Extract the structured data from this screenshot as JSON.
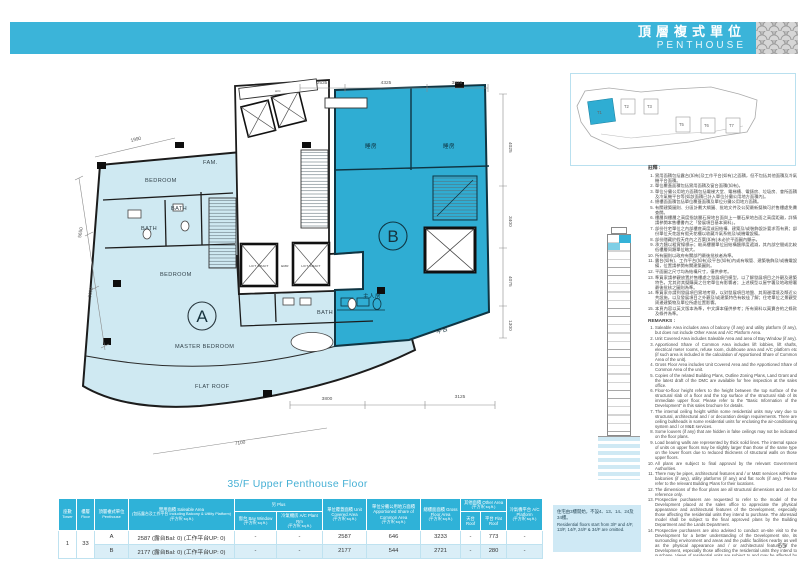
{
  "page": {
    "number": "55",
    "caption": "35/F Upper Penthouse Floor",
    "accent_color": "#3bb4d9",
    "unit_b_color": "#2fadd3",
    "unit_a_color": "#cfe9f2"
  },
  "header": {
    "title_zh": "頂層複式單位",
    "title_en": "PENTHOUSE"
  },
  "keyplan": {
    "towers": [
      "T1",
      "T2",
      "T3",
      "T5",
      "T6",
      "T7"
    ]
  },
  "plan": {
    "unit_a_label": "A",
    "unit_b_label": "B",
    "rooms": {
      "bedroom1": "BEDROOM",
      "fam": "FAM.",
      "bath1": "BATH",
      "bath2": "BATH",
      "bedroom2": "BEDROOM",
      "master_bedroom": "MASTER BEDROOM",
      "flat_roof": "FLAT ROOF",
      "bath3": "BATH",
      "lift_shaft1": "LIFT SHAFT",
      "emr": "EMR",
      "lift_shaft2": "LIFT SHAFT",
      "ac": "A/C",
      "bedroom_zh1": "睡房",
      "bedroom_zh2": "睡房",
      "master_zh": "主人房",
      "flat_roof_zh": "平台"
    },
    "dims": {
      "top": [
        "2535",
        "4325",
        "3825"
      ],
      "right": [
        "4025",
        "3400",
        "4075",
        "1300"
      ],
      "bottom": [
        "3800",
        "3125"
      ],
      "left": [
        "1990",
        "5650",
        "3600"
      ],
      "diagonal": "7100"
    }
  },
  "table": {
    "headers": {
      "tower": {
        "l1": "座數",
        "l2": "Tower"
      },
      "floor": {
        "l1": "樓層",
        "l2": "Floor"
      },
      "penthouse": {
        "l1": "頂層複式單位",
        "l2": "Penthouse"
      },
      "saleable": {
        "l1": "實用面積 Saleable Area",
        "l2": "(包括露台及工作平台 Including Balcony & Utility Platform)",
        "l3": "(平方呎 sq.ft.)"
      },
      "plus": {
        "l1": "另 Plus"
      },
      "bay_window": {
        "l1": "窗台 Bay Window",
        "l2": "(平方呎 sq.ft.)"
      },
      "ac_plant": {
        "l1": "冷氣機房 A/C Plant Rm",
        "l2": "(平方呎 sq.ft.)"
      },
      "unit_covered": {
        "l1": "單位覆蓋面積 Unit Covered Area",
        "l2": "(平方呎 sq.ft.)"
      },
      "apportioned": {
        "l1": "單位分攤公用地方面積 Apportioned Share of Common Area",
        "l2": "(平方呎 sq.ft.)"
      },
      "gfa": {
        "l1": "總樓面面積 Gross Floor Area",
        "l2": "(平方呎 sq.ft.)"
      },
      "other": {
        "l1": "其他面積 Other Area",
        "l2": "(平方呎 sq.ft.)"
      },
      "roof": {
        "l1": "天台 Roof"
      },
      "flat_roof": {
        "l1": "平台 Flat Roof"
      },
      "ac_platform": {
        "l1": "冷氣機平台 A/C Platform",
        "l2": "(平方呎 sq.ft.)"
      }
    },
    "rows": [
      {
        "tower": "1",
        "floor": "33",
        "unit": "A",
        "saleable": "2587 (露台Bal: 0) (工作平台UP: 0)",
        "bay": "-",
        "ac_plant": "-",
        "covered": "2587",
        "apportioned": "646",
        "gfa": "3233",
        "roof": "-",
        "flat_roof": "773",
        "ac_platform": "-"
      },
      {
        "unit": "B",
        "saleable": "2177 (露台Bal: 0) (工作平台UP: 0)",
        "bay": "-",
        "ac_plant": "-",
        "covered": "2177",
        "apportioned": "544",
        "gfa": "2721",
        "roof": "-",
        "flat_roof": "280",
        "ac_platform": "-"
      }
    ],
    "note_zh": "住宅由3樓開始，不設4、13、14、24及34樓。",
    "note_en": "Residential floors start from 3/F and 4/F, 13/F, 14/F, 24/F & 34/F are omitted."
  },
  "remarks": {
    "title_zh": "註釋 :",
    "title_en": "REMARKS :",
    "zh": [
      "實用面積包括露台(如有)及工作平台(如有)之面積，但不包括其他面積及冷氣機平台面積。",
      "單位覆蓋面積包括實用面積及窗台面積(如有)。",
      "單位分攤公用地方面積包括電梯大堂、電梯槽、電錶房、垃圾房、會所面積及冷氣機平台等(如該面積已計入單位分攤公用地方面積內)。",
      "總樓面面積包括單位覆蓋面積及單位分攤公用地方面積。",
      "有關建築圖則、分區計劃大綱圖、批地文件及公契最新擬稿可於售樓處免費查閱。",
      "樓層與樓層之高度指該層石屎地台面與上一層石屎地台面之高度距離，詳情請參閱本售樓書內之「發展項目基本資料」。",
      "部份住宅單位之內部樓底高度或因結構、建築及/或裝飾設計要求而有異；部份單位天花設有假天花槽以收藏冷氣系統及/或機電設備。",
      "部份隱藏於假天花內之百葉(如有)未必於平面圖內顯示。",
      "承力牆以粗實線標示；較高樓層單位因結構牆厚度遞減，其內部空間或比較低樓層同類單位略大。",
      "所有圖則以政府有關部門最後批核者為準。",
      "露台(如有)、工作平台(如有)及平台(如有)內或有喉管、建築裝飾及/或機電設備，位置請參閱有關建築圖則。",
      "平面圖之尺寸均為結構尺寸，僅供參考。",
      "準買家請參觀放置於售樓處之發展項目模型，以了解發展項目之外觀及建築特色，尤其對其擬購買之住宅單位有影響者；上述模型以屋宇署及地政總署最後批核之圖則為準。",
      "準買家亦請到發展項目實地考察，以對發展項目地盤、其周邊環境及鄰近公共設施，以及發展項目之外觀及/或建築特色有較佳了解；住宅單位之景觀受周邊建築物及單位所處位置影響。",
      "本頁內容以英文版本為準，中文譯本僅供參考；所有資料以買賣合約之條款及條件為準。"
    ],
    "en": [
      "Saleable Area includes area of balcony (if any) and utility platform (if any), but does not include Other Areas and A/C Platform Area.",
      "Unit Covered Area includes Saleable Area and area of Bay Window (if any).",
      "Apportioned Share of Common Area includes lift lobbies, lift shafts, electrical meter rooms, refuse room, clubhouse area and A/C platform etc (if such area is included in the calculation of Apportioned Share of Common Area of the unit).",
      "Gross Floor Area includes Unit Covered Area and the Apportioned Share of Common Area of the unit.",
      "Copies of the related Building Plans, Outline Zoning Plans, Land Grant and the latest draft of the DMC are available for free inspection at the sales office.",
      "Floor-to-floor height refers to the height between the top surface of the structural slab of a floor and the top surface of the structural slab of its immediate upper floor. Please refer to the \"Basic Information of the Development\" in this sales brochure for details.",
      "The internal ceiling height within some residential units may vary due to structural, architectural and / or decoration design requirements. There are ceiling bulkheads in some residential units for enclosing the air-conditioning system and / or M&E services.",
      "Some louvers (if any) that are hidden in false ceilings may not be indicated on the floor plans.",
      "Load bearing walls are represented by thick solid lines. The internal space of units on upper floors may be slightly larger than those of the same type on the lower floors due to reduced thickness of structural walls on those upper floors.",
      "All plans are subject to final approval by the relevant Government Authorities.",
      "There may be pipes, architectural features and / or M&E services within the balconies (if any), utility platforms (if any) and flat roofs (if any). Please refer to the relevant Building Plans for their locations.",
      "The dimensions of the floor plans are all structural dimensions and are for reference only.",
      "Prospective purchasers are requested to refer to the model of the Development placed at the sales office to appreciate the physical appearance and architectural features of the Development, especially those affecting the residential units they intend to purchase. The aforesaid model shall be subject to the final approved plans by the Building Department and the Lands Department.",
      "Prospective purchasers are also advised to conduct on-site visit to the Development for a better understanding of the Development site, its surrounding environment and areas and the public facilities nearby as well as the physical appearance and / or architectural feature of the Development, especially those affecting the residential units they intend to purchase. Views of residential units are subject to and may be affected by the surrounding buildings and the location of the unit itself.",
      "Contents of this page shall be based on the English version and the Chinese version is for reference only. All information shall be subject to the terms and conditions of the Agreement for Sale and Purchase."
    ]
  }
}
